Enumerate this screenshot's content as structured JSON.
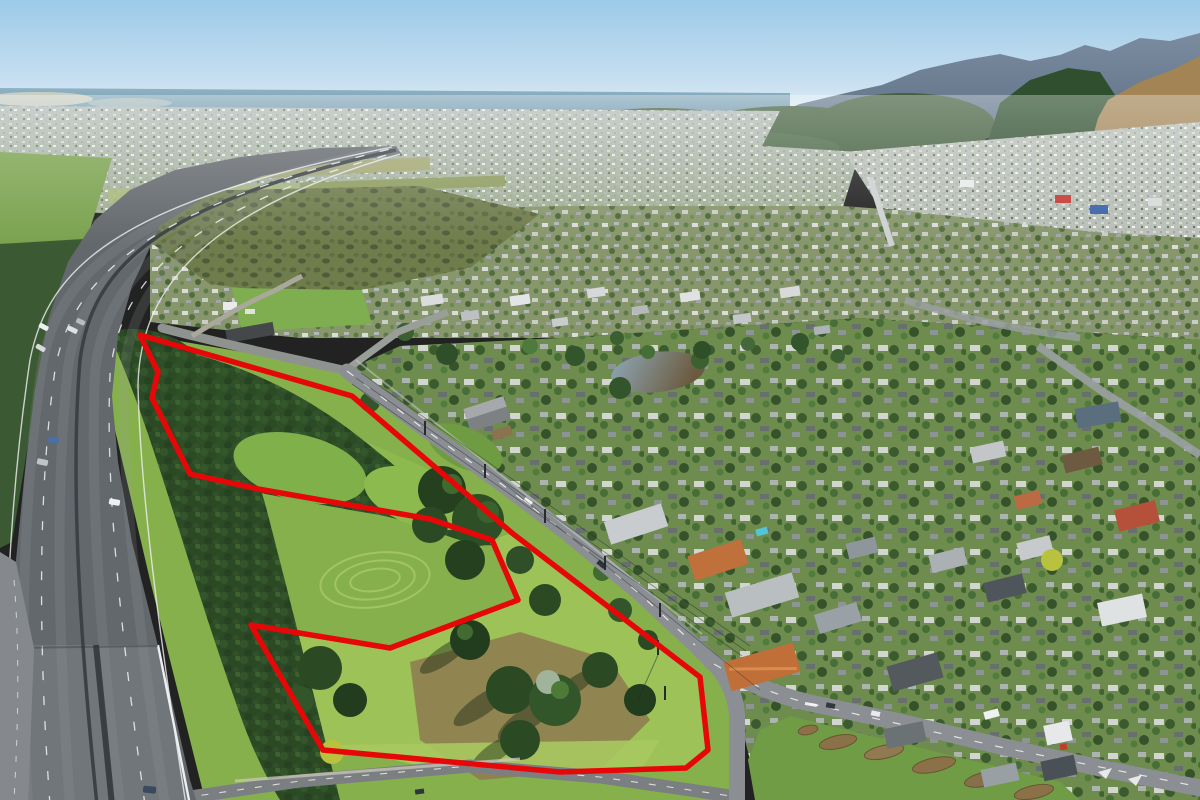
{
  "meta": {
    "type": "aerial-photograph",
    "width": 1200,
    "height": 800,
    "description": "Oblique aerial photo of a coastal town: multi-lane motorway curving down the left side over a local-road underpass, a vacant grassy/bush-covered property outlined in red in the foreground, a two-lane road running diagonally along the property's north-east edge to a junction with a planted median island at lower right, dense suburbs and a commercial town centre in the middle distance, an olive wetland and farm strips beyond, the ocean on the horizon at upper left and bush-clad hills with a tan grassy escarpment at upper right."
  },
  "boundary": {
    "points": "140,335 352,396 512,533 700,677 708,750 686,768 560,772 430,760 323,750 251,625 390,648 518,600 492,540 430,519 258,489 190,474 152,398 158,372",
    "color": "#e60708",
    "stroke_width": "5.5"
  },
  "palette": {
    "sky_top": "#9ccae9",
    "sky_mid": "#c7dff0",
    "sky_horizon": "#eaf2f6",
    "ocean_far": "#8fb3c4",
    "ocean_near": "#6a91a7",
    "sand_glint": "#d9d7c6",
    "far_town": "#b3bcb8",
    "far_town_low": "#9fae90",
    "hills_far_top": "#7b8ba0",
    "hills_far_bottom": "#5d7085",
    "bush_hills": "#44603f",
    "escarpment": "#2f4f2e",
    "tan_hill": "#a28455",
    "town_base": "#b9bfb7",
    "main_street": "#cdd1d2",
    "suburb_mid": "#87966b",
    "suburb_right": "#6e8c4e",
    "scrub": "#6f7c4b",
    "paddock": "#7aa24e",
    "airstrip": "#a8b877",
    "grass_base": "#86b04b",
    "grass_sunlit": "#9dc257",
    "grass_bottom": "#a7c95f",
    "dirt": "#8f7e51",
    "bush_dark": "#2c4a26",
    "bush_mid": "#35582c",
    "motorway": "#63686d",
    "bridge_deck": "#7b8086",
    "ramp": "#85898d",
    "road": "#8b8f93",
    "road_minor": "#a9a89b",
    "marking": "#f2f4f5",
    "median_grass": "#6f9c44",
    "garden_bed": "#8b7148",
    "pond_light": "#8fa9b8",
    "pond_dark": "#6b5a3e",
    "power_line": "#20262a"
  }
}
